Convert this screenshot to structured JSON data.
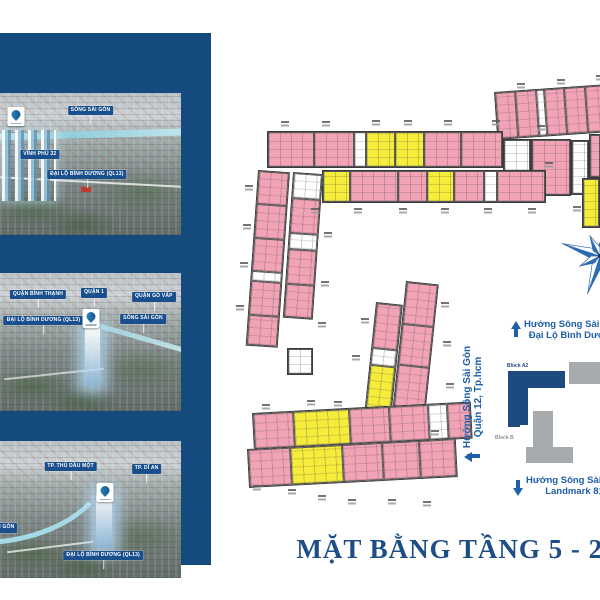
{
  "title": "MẶT BẰNG TẦNG 5 - 28",
  "colors": {
    "sidebar_navy": "#154a7e",
    "pill_navy": "#1a4f8d",
    "unit_pink": "#f2a4b6",
    "unit_yellow": "#f6ec3c",
    "note_blue": "#1d5fa8",
    "block_a2_navy": "#1d4b7f",
    "block_b_gray": "#a7abae",
    "title_navy": "#1d4e86"
  },
  "sidebar": {
    "photos": [
      {
        "pills": [
          {
            "text": "SÔNG SÀI GÒN",
            "x": 50,
            "y": 9
          },
          {
            "text": "VĨNH PHÚ 32",
            "x": 22,
            "y": 40
          },
          {
            "text": "ĐẠI LỘ BÌNH DƯƠNG (QL13)",
            "x": 48,
            "y": 54
          }
        ],
        "logo": {
          "x": 9,
          "y": 10
        }
      },
      {
        "pills": [
          {
            "text": "QUẬN BÌNH THẠNH",
            "x": 21,
            "y": 12
          },
          {
            "text": "QUẬN 1",
            "x": 52,
            "y": 11
          },
          {
            "text": "QUẬN GÒ VẤP",
            "x": 85,
            "y": 14
          },
          {
            "text": "ĐẠI LỘ BÌNH DƯƠNG (QL13)",
            "x": 24,
            "y": 31
          },
          {
            "text": "SÔNG SÀI GÒN",
            "x": 79,
            "y": 30
          }
        ],
        "logo": {
          "x": 50,
          "y": 26
        }
      },
      {
        "pills": [
          {
            "text": "TP. THỦ DẦU MỘT",
            "x": 39,
            "y": 15
          },
          {
            "text": "TP. DĨ AN",
            "x": 81,
            "y": 17
          },
          {
            "text": "SÔNG SÀI GÒN",
            "x": -3,
            "y": 60
          },
          {
            "text": "ĐẠI LỘ BÌNH DƯƠNG (QL13)",
            "x": 57,
            "y": 80
          }
        ],
        "logo": {
          "x": 58,
          "y": 31
        }
      }
    ]
  },
  "notes": {
    "top": [
      "Hướng Sông Sài Gòn",
      "Đại Lộ Bình Dương"
    ],
    "side": [
      "Hướng Sông Sài Gòn",
      "Quận 12, Tp.hcm"
    ],
    "bottom": [
      "Hướng Sông Sài Gòn",
      "Landmark 81"
    ]
  },
  "minimap": {
    "block_a2": "Block A2",
    "block_b": "Block B"
  },
  "plan": {
    "strips": [
      {
        "x": 494,
        "y": 92,
        "w": 110,
        "h": 48,
        "r": -4,
        "d": "row",
        "cells": [
          [
            "p",
            1
          ],
          [
            "p",
            1
          ],
          [
            "w",
            0.35
          ],
          [
            "p",
            1
          ],
          [
            "p",
            1
          ],
          [
            "p",
            0.9
          ]
        ]
      },
      {
        "x": 267,
        "y": 131,
        "w": 236,
        "h": 37,
        "r": 0,
        "d": "row",
        "cells": [
          [
            "p",
            1.3
          ],
          [
            "p",
            1.1
          ],
          [
            "w",
            0.28
          ],
          [
            "y",
            0.8
          ],
          [
            "y",
            0.8
          ],
          [
            "p",
            1
          ],
          [
            "p",
            1.15
          ]
        ]
      },
      {
        "x": 503,
        "y": 139,
        "w": 28,
        "h": 57,
        "r": 0,
        "d": "row",
        "cells": [
          [
            "w",
            1
          ]
        ]
      },
      {
        "x": 531,
        "y": 139,
        "w": 40,
        "h": 57,
        "r": 0,
        "d": "row",
        "cells": [
          [
            "p",
            1
          ]
        ]
      },
      {
        "x": 571,
        "y": 140,
        "w": 18,
        "h": 55,
        "r": 0,
        "d": "row",
        "cells": [
          [
            "w",
            1
          ]
        ]
      },
      {
        "x": 589,
        "y": 134,
        "w": 12,
        "h": 44,
        "r": 0,
        "d": "row",
        "cells": [
          [
            "p",
            1
          ]
        ]
      },
      {
        "x": 582,
        "y": 178,
        "w": 18,
        "h": 50,
        "r": 0,
        "d": "col",
        "cells": [
          [
            "y",
            1
          ]
        ]
      },
      {
        "x": 322,
        "y": 170,
        "w": 224,
        "h": 33,
        "r": 0,
        "d": "row",
        "cells": [
          [
            "y",
            0.55
          ],
          [
            "p",
            1
          ],
          [
            "p",
            0.6
          ],
          [
            "y",
            0.55
          ],
          [
            "p",
            0.6
          ],
          [
            "w",
            0.25
          ],
          [
            "p",
            1
          ]
        ]
      },
      {
        "x": 258,
        "y": 170,
        "w": 32,
        "h": 176,
        "r": 4,
        "d": "col",
        "cells": [
          [
            "p",
            1
          ],
          [
            "p",
            1
          ],
          [
            "p",
            1
          ],
          [
            "w",
            0.25
          ],
          [
            "p",
            1
          ],
          [
            "p",
            0.9
          ]
        ]
      },
      {
        "x": 293,
        "y": 172,
        "w": 30,
        "h": 146,
        "r": 4,
        "d": "col",
        "cells": [
          [
            "w",
            0.7
          ],
          [
            "p",
            1
          ],
          [
            "w",
            0.45
          ],
          [
            "p",
            1
          ],
          [
            "p",
            0.95
          ]
        ]
      },
      {
        "x": 287,
        "y": 348,
        "w": 26,
        "h": 27,
        "r": 0,
        "d": "row",
        "cells": [
          [
            "w",
            1
          ]
        ]
      },
      {
        "x": 376,
        "y": 302,
        "w": 27,
        "h": 152,
        "r": 6,
        "d": "col",
        "cells": [
          [
            "p",
            1.1
          ],
          [
            "w",
            0.4
          ],
          [
            "y",
            1.2
          ],
          [
            "w",
            0.5
          ],
          [
            "p",
            0.4
          ]
        ]
      },
      {
        "x": 406,
        "y": 281,
        "w": 33,
        "h": 178,
        "r": 6,
        "d": "col",
        "cells": [
          [
            "p",
            1
          ],
          [
            "p",
            1
          ],
          [
            "p",
            1
          ],
          [
            "p",
            1
          ],
          [
            "w",
            0.2
          ]
        ]
      },
      {
        "x": 252,
        "y": 413,
        "w": 219,
        "h": 37,
        "r": -3,
        "d": "row",
        "cells": [
          [
            "p",
            0.9
          ],
          [
            "y",
            1.3
          ],
          [
            "p",
            0.9
          ],
          [
            "p",
            0.9
          ],
          [
            "w",
            0.4
          ],
          [
            "p",
            0.5
          ]
        ]
      },
      {
        "x": 247,
        "y": 449,
        "w": 209,
        "h": 39,
        "r": -3,
        "d": "row",
        "cells": [
          [
            "p",
            0.95
          ],
          [
            "y",
            1.2
          ],
          [
            "p",
            0.9
          ],
          [
            "p",
            0.85
          ],
          [
            "p",
            0.8
          ]
        ]
      }
    ],
    "marks": [
      [
        517,
        83
      ],
      [
        557,
        79
      ],
      [
        596,
        75
      ],
      [
        281,
        121
      ],
      [
        322,
        121
      ],
      [
        372,
        120
      ],
      [
        404,
        120
      ],
      [
        444,
        120
      ],
      [
        492,
        120
      ],
      [
        537,
        125
      ],
      [
        545,
        162
      ],
      [
        573,
        206
      ],
      [
        311,
        208
      ],
      [
        354,
        208
      ],
      [
        399,
        208
      ],
      [
        441,
        208
      ],
      [
        484,
        208
      ],
      [
        528,
        208
      ],
      [
        245,
        185
      ],
      [
        243,
        224
      ],
      [
        240,
        262
      ],
      [
        236,
        305
      ],
      [
        324,
        232
      ],
      [
        321,
        281
      ],
      [
        318,
        322
      ],
      [
        361,
        318
      ],
      [
        352,
        355
      ],
      [
        441,
        302
      ],
      [
        443,
        341
      ],
      [
        446,
        383
      ],
      [
        431,
        430
      ],
      [
        262,
        404
      ],
      [
        307,
        400
      ],
      [
        334,
        401
      ],
      [
        253,
        485
      ],
      [
        288,
        489
      ],
      [
        318,
        495
      ],
      [
        348,
        499
      ],
      [
        388,
        499
      ],
      [
        423,
        501
      ]
    ]
  }
}
